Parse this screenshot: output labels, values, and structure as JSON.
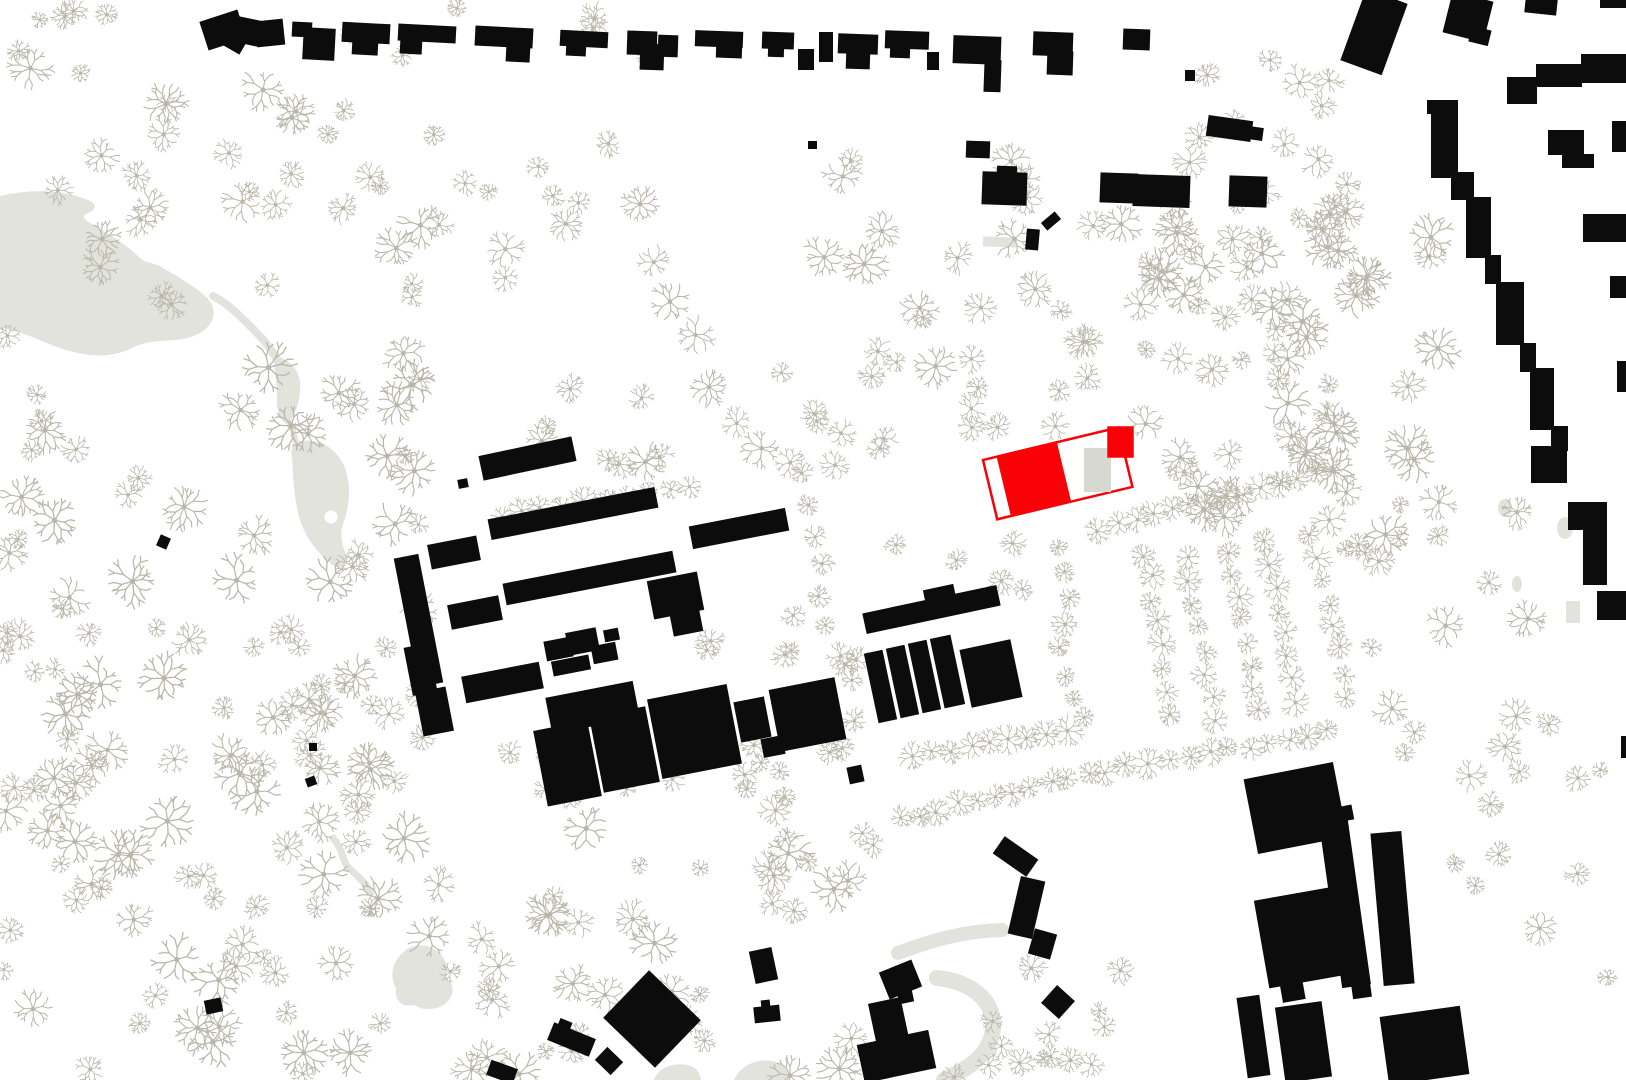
{
  "canvas": {
    "width": 1626,
    "height": 1080
  },
  "colors": {
    "background": "#ffffff",
    "building": "#0c0c0c",
    "tree": "#b7b7a9",
    "water": "#e3e3de",
    "path": "#e3e3de",
    "accent_red": "#f90207",
    "inner_gray": "#d8d8d3"
  },
  "water": {
    "lake": "M0,196 C30,189 62,189 88,200 C98,204 97,210 86,214 C82,216 84,220 92,224 C110,234 128,246 140,258 C146,264 154,262 163,268 C180,278 198,288 209,300 C218,311 214,326 198,334 C176,345 156,336 132,348 C104,362 72,354 42,341 C24,333 10,330 0,327 Z",
    "stream": "M213,296 C228,304 238,314 248,324 C260,336 270,346 277,360",
    "pond1": "M277,356 C294,362 302,374 300,392 C298,410 292,420 287,424 C278,420 276,406 277,392 C276,376 272,362 277,356 Z",
    "connector": "M288,420 C293,430 295,436 296,444",
    "pond2": "M296,442 C318,436 337,448 345,468 C352,488 349,508 343,524 C339,536 343,548 347,556 C350,566 340,572 330,563 C312,548 301,530 297,508 C293,488 293,470 292,458 C291,448 292,444 296,442 Z",
    "island": {
      "cx": 331,
      "cy": 517,
      "r": 6.5
    }
  },
  "paths": {
    "strokes": [
      {
        "d": "M898,953 C930,941 962,931 1002,930",
        "w": 14
      },
      {
        "d": "M937,978 C967,981 989,996 993,1019 C995,1041 984,1058 961,1071 C953,1076 948,1078 944,1080",
        "w": 16
      },
      {
        "d": "M333,838 C344,850 341,862 351,870 C360,878 367,885 371,893",
        "w": 7
      }
    ],
    "fills": [
      "M654,1080 C658,1068 672,1062 688,1065 C696,1067 700,1073 701,1080 Z",
      "M734,1080 C740,1066 756,1058 772,1061 C783,1063 789,1071 790,1080 Z",
      "M398,958 C406,946 420,942 432,948 C444,954 450,966 446,978 C453,982 455,992 449,1000 C441,1010 425,1012 414,1005 C402,1008 394,1000 396,988 C390,978 392,966 398,958 Z"
    ],
    "blobs": [
      {
        "cx": 1565,
        "cy": 528,
        "rx": 8,
        "ry": 11
      },
      {
        "cx": 1505,
        "cy": 508,
        "rx": 7,
        "ry": 9
      },
      {
        "cx": 1517,
        "cy": 584,
        "rx": 5,
        "ry": 8
      }
    ],
    "gray_rects": [
      [
        983,
        237,
        34,
        10,
        2
      ],
      [
        1566,
        601,
        14,
        22,
        0
      ]
    ]
  },
  "red_building": {
    "origin": [
      983,
      460
    ],
    "rot": -13.5,
    "w": 139,
    "h": 61,
    "red_fill_rect": [
      14,
      1,
      62,
      59
    ],
    "corner_square": [
      1108,
      427,
      25,
      30
    ],
    "gray_rect": [
      1084,
      448,
      27,
      44
    ],
    "stroke_w": 2.5
  },
  "buildings": [
    [
      203,
      15,
      40,
      30,
      -18
    ],
    [
      230,
      18,
      32,
      26,
      12
    ],
    [
      256,
      20,
      28,
      26,
      -6
    ],
    [
      222,
      30,
      24,
      20,
      30
    ],
    [
      292,
      22,
      20,
      15,
      3
    ],
    [
      303,
      28,
      32,
      32,
      3
    ],
    [
      342,
      23,
      48,
      20,
      3
    ],
    [
      352,
      40,
      26,
      15,
      3
    ],
    [
      398,
      25,
      58,
      17,
      3
    ],
    [
      400,
      40,
      22,
      14,
      3
    ],
    [
      475,
      27,
      58,
      20,
      3
    ],
    [
      506,
      45,
      24,
      17,
      3
    ],
    [
      560,
      31,
      48,
      16,
      3
    ],
    [
      566,
      44,
      20,
      12,
      3
    ],
    [
      627,
      31,
      30,
      24,
      2
    ],
    [
      640,
      44,
      24,
      26,
      2
    ],
    [
      658,
      35,
      20,
      22,
      2
    ],
    [
      695,
      31,
      48,
      16,
      2
    ],
    [
      716,
      44,
      26,
      14,
      2
    ],
    [
      762,
      32,
      32,
      17,
      2
    ],
    [
      768,
      45,
      16,
      12,
      2
    ],
    [
      798,
      49,
      16,
      21,
      0
    ],
    [
      819,
      32,
      14,
      30,
      0
    ],
    [
      838,
      34,
      40,
      20,
      2
    ],
    [
      846,
      51,
      24,
      18,
      2
    ],
    [
      885,
      31,
      44,
      18,
      2
    ],
    [
      890,
      46,
      20,
      12,
      2
    ],
    [
      927,
      52,
      12,
      18,
      0
    ],
    [
      953,
      36,
      48,
      28,
      2
    ],
    [
      984,
      60,
      17,
      32,
      2
    ],
    [
      1033,
      32,
      40,
      24,
      2
    ],
    [
      1047,
      51,
      26,
      24,
      2
    ],
    [
      1123,
      29,
      27,
      21,
      2
    ],
    [
      1207,
      118,
      45,
      21,
      8
    ],
    [
      1248,
      127,
      15,
      13,
      8
    ],
    [
      1185,
      70,
      10,
      11,
      0
    ],
    [
      1352,
      -6,
      44,
      76,
      20
    ],
    [
      1447,
      -4,
      42,
      42,
      14
    ],
    [
      1470,
      28,
      20,
      16,
      14
    ],
    [
      1525,
      -2,
      32,
      16,
      6
    ],
    [
      1600,
      -4,
      26,
      12,
      0
    ],
    [
      1507,
      77,
      30,
      27,
      0
    ],
    [
      1536,
      64,
      46,
      23,
      0
    ],
    [
      1581,
      54,
      45,
      29,
      0
    ],
    [
      1427,
      100,
      31,
      14,
      0
    ],
    [
      1431,
      112,
      27,
      66,
      0
    ],
    [
      1451,
      172,
      23,
      28,
      0
    ],
    [
      1466,
      197,
      25,
      61,
      0
    ],
    [
      1485,
      255,
      16,
      29,
      0
    ],
    [
      1496,
      282,
      28,
      63,
      0
    ],
    [
      1520,
      343,
      16,
      29,
      0
    ],
    [
      1530,
      368,
      24,
      62,
      0
    ],
    [
      1551,
      426,
      17,
      25,
      0
    ],
    [
      1531,
      446,
      36,
      37,
      0
    ],
    [
      1553,
      462,
      14,
      21,
      0
    ],
    [
      1548,
      130,
      36,
      25,
      0
    ],
    [
      1562,
      154,
      32,
      14,
      0
    ],
    [
      1612,
      121,
      14,
      31,
      0
    ],
    [
      1583,
      214,
      43,
      28,
      0
    ],
    [
      1610,
      276,
      16,
      22,
      0
    ],
    [
      1617,
      361,
      9,
      31,
      0
    ],
    [
      1568,
      502,
      39,
      28,
      0
    ],
    [
      1583,
      528,
      24,
      57,
      0
    ],
    [
      1597,
      591,
      29,
      29,
      0
    ],
    [
      1621,
      736,
      5,
      22,
      0
    ],
    [
      966,
      141,
      24,
      17,
      2
    ],
    [
      982,
      172,
      45,
      33,
      2
    ],
    [
      997,
      166,
      20,
      8,
      2
    ],
    [
      1100,
      173,
      38,
      30,
      2
    ],
    [
      1133,
      175,
      57,
      32,
      2
    ],
    [
      1229,
      176,
      38,
      31,
      2
    ],
    [
      1042,
      216,
      18,
      10,
      -40
    ],
    [
      1026,
      229,
      13,
      21,
      5
    ],
    [
      808,
      141,
      9,
      8,
      0
    ],
    [
      480,
      446,
      95,
      25,
      -12
    ],
    [
      429,
      540,
      50,
      25,
      -11
    ],
    [
      488,
      503,
      170,
      21,
      -11
    ],
    [
      449,
      600,
      52,
      25,
      -11
    ],
    [
      503,
      567,
      173,
      22,
      -11
    ],
    [
      690,
      517,
      98,
      23,
      -11
    ],
    [
      406,
      555,
      25,
      131,
      -11
    ],
    [
      408,
      645,
      25,
      49,
      -11
    ],
    [
      419,
      689,
      31,
      45,
      -11
    ],
    [
      463,
      669,
      79,
      27,
      -11
    ],
    [
      545,
      639,
      27,
      20,
      -11
    ],
    [
      567,
      630,
      31,
      23,
      -11
    ],
    [
      592,
      644,
      25,
      18,
      -11
    ],
    [
      604,
      629,
      15,
      12,
      -11
    ],
    [
      552,
      658,
      38,
      15,
      -11
    ],
    [
      650,
      576,
      51,
      39,
      -11
    ],
    [
      671,
      607,
      30,
      27,
      -11
    ],
    [
      548,
      689,
      89,
      37,
      -11
    ],
    [
      540,
      725,
      55,
      77,
      -11
    ],
    [
      596,
      711,
      57,
      77,
      -11
    ],
    [
      654,
      691,
      81,
      81,
      -11
    ],
    [
      737,
      699,
      31,
      41,
      -11
    ],
    [
      762,
      737,
      22,
      19,
      -11
    ],
    [
      774,
      683,
      67,
      63,
      -11
    ],
    [
      458,
      479,
      10,
      9,
      -11
    ],
    [
      863,
      599,
      137,
      21,
      -12
    ],
    [
      924,
      587,
      31,
      14,
      -12
    ],
    [
      871,
      651,
      19,
      71,
      -12
    ],
    [
      893,
      646,
      19,
      71,
      -12
    ],
    [
      915,
      641,
      19,
      71,
      -12
    ],
    [
      937,
      636,
      21,
      71,
      -12
    ],
    [
      965,
      644,
      52,
      59,
      -12
    ],
    [
      848,
      766,
      15,
      17,
      -12
    ],
    [
      752,
      949,
      23,
      33,
      -12
    ],
    [
      754,
      1006,
      26,
      16,
      -6
    ],
    [
      761,
      1000,
      9,
      7,
      -6
    ],
    [
      883,
      965,
      35,
      29,
      -22
    ],
    [
      872,
      1000,
      33,
      42,
      -12
    ],
    [
      860,
      1037,
      73,
      39,
      -12
    ],
    [
      898,
      990,
      15,
      13,
      -12
    ],
    [
      995,
      846,
      41,
      21,
      35
    ],
    [
      1014,
      878,
      25,
      59,
      13
    ],
    [
      1031,
      931,
      23,
      26,
      16
    ],
    [
      1046,
      990,
      24,
      24,
      42
    ],
    [
      549,
      1030,
      45,
      19,
      22
    ],
    [
      558,
      1020,
      13,
      11,
      22
    ],
    [
      616,
      986,
      72,
      66,
      44
    ],
    [
      598,
      1052,
      22,
      18,
      44
    ],
    [
      488,
      1064,
      28,
      16,
      20
    ],
    [
      205,
      999,
      17,
      14,
      -12
    ],
    [
      158,
      536,
      11,
      12,
      24
    ],
    [
      309,
      743,
      8,
      8,
      0
    ],
    [
      306,
      777,
      10,
      9,
      -20
    ],
    [
      1250,
      770,
      91,
      76,
      -11
    ],
    [
      1336,
      806,
      17,
      15,
      -11
    ],
    [
      1330,
      814,
      29,
      173,
      -8
    ],
    [
      1377,
      832,
      31,
      153,
      -5
    ],
    [
      1261,
      893,
      81,
      89,
      -10
    ],
    [
      1281,
      980,
      23,
      21,
      -10
    ],
    [
      1242,
      996,
      23,
      81,
      -8
    ],
    [
      1280,
      1004,
      47,
      76,
      -8
    ],
    [
      1384,
      1011,
      81,
      69,
      -8
    ],
    [
      1352,
      983,
      19,
      15,
      -8
    ]
  ],
  "trees": {
    "rows": [
      {
        "pts": [
          [
            640,
            205
          ],
          [
            655,
            262
          ],
          [
            670,
            302
          ],
          [
            697,
            335
          ],
          [
            710,
            388
          ],
          [
            736,
            424
          ],
          [
            762,
            448
          ],
          [
            792,
            463
          ]
        ],
        "r": 15,
        "seed": 301
      },
      {
        "from": [
          500,
          514
        ],
        "to": [
          690,
          486
        ],
        "n": 10,
        "r": 11,
        "seed": 302
      },
      {
        "pts": [
          [
            800,
            472
          ],
          [
            808,
            505
          ],
          [
            816,
            535
          ],
          [
            822,
            565
          ],
          [
            820,
            595
          ],
          [
            826,
            625
          ],
          [
            840,
            655
          ],
          [
            852,
            680
          ]
        ],
        "r": 11,
        "seed": 303
      },
      {
        "from": [
          913,
          757
        ],
        "to": [
          1067,
          729
        ],
        "n": 9,
        "r": 11,
        "seed": 304
      },
      {
        "from": [
          900,
          818
        ],
        "to": [
          1145,
          762
        ],
        "n": 14,
        "r": 11,
        "seed": 305
      },
      {
        "from": [
          1170,
          762
        ],
        "to": [
          1327,
          731
        ],
        "n": 9,
        "r": 11,
        "seed": 306
      },
      {
        "from": [
          1100,
          529
        ],
        "to": [
          1332,
          470
        ],
        "n": 14,
        "r": 11,
        "seed": 307
      },
      {
        "pts": [
          [
            1056,
            546
          ],
          [
            1065,
            572
          ],
          [
            1071,
            597
          ],
          [
            1066,
            623
          ],
          [
            1060,
            649
          ],
          [
            1066,
            675
          ],
          [
            1075,
            699
          ],
          [
            1083,
            717
          ]
        ],
        "r": 10,
        "seed": 308
      },
      {
        "from": [
          1146,
          554
        ],
        "to": [
          1172,
          715
        ],
        "n": 8,
        "r": 11,
        "seed": 309
      },
      {
        "from": [
          1186,
          560
        ],
        "to": [
          1215,
          718
        ],
        "n": 8,
        "r": 11,
        "seed": 310
      },
      {
        "from": [
          1228,
          552
        ],
        "to": [
          1258,
          709
        ],
        "n": 8,
        "r": 11,
        "seed": 311
      },
      {
        "from": [
          1266,
          543
        ],
        "to": [
          1297,
          700
        ],
        "n": 8,
        "r": 11,
        "seed": 312
      },
      {
        "from": [
          1312,
          532
        ],
        "to": [
          1348,
          696
        ],
        "n": 8,
        "r": 11,
        "seed": 313
      }
    ],
    "clusters": [
      {
        "x": 0,
        "y": 55,
        "w": 320,
        "h": 150,
        "count": 16,
        "rmin": 9,
        "rmax": 20,
        "seed": 11
      },
      {
        "x": 0,
        "y": 200,
        "w": 430,
        "h": 360,
        "count": 42,
        "rmin": 9,
        "rmax": 24,
        "seed": 22
      },
      {
        "x": 0,
        "y": 560,
        "w": 440,
        "h": 520,
        "count": 105,
        "rmin": 9,
        "rmax": 23,
        "seed": 33
      },
      {
        "x": 440,
        "y": 820,
        "w": 440,
        "h": 260,
        "count": 42,
        "rmin": 8,
        "rmax": 22,
        "seed": 44
      },
      {
        "x": 430,
        "y": 240,
        "w": 250,
        "h": 230,
        "count": 11,
        "rmin": 9,
        "rmax": 20,
        "seed": 55
      },
      {
        "x": 290,
        "y": 110,
        "w": 370,
        "h": 120,
        "count": 13,
        "rmin": 8,
        "rmax": 18,
        "seed": 66
      },
      {
        "x": 760,
        "y": 155,
        "w": 590,
        "h": 145,
        "count": 26,
        "rmin": 9,
        "rmax": 21,
        "seed": 77
      },
      {
        "x": 760,
        "y": 300,
        "w": 220,
        "h": 170,
        "count": 15,
        "rmin": 9,
        "rmax": 20,
        "seed": 78
      },
      {
        "x": 900,
        "y": 305,
        "w": 190,
        "h": 125,
        "count": 8,
        "rmin": 8,
        "rmax": 16,
        "seed": 88
      },
      {
        "x": 1150,
        "y": 230,
        "w": 290,
        "h": 330,
        "count": 48,
        "rmin": 9,
        "rmax": 23,
        "seed": 99
      },
      {
        "x": 1190,
        "y": 60,
        "w": 160,
        "h": 170,
        "count": 12,
        "rmin": 8,
        "rmax": 18,
        "seed": 98
      },
      {
        "x": 1340,
        "y": 470,
        "w": 190,
        "h": 290,
        "count": 16,
        "rmin": 8,
        "rmax": 19,
        "seed": 100
      },
      {
        "x": 1430,
        "y": 720,
        "w": 180,
        "h": 320,
        "count": 13,
        "rmin": 8,
        "rmax": 18,
        "seed": 111
      },
      {
        "x": 880,
        "y": 1040,
        "w": 240,
        "h": 40,
        "count": 6,
        "rmin": 7,
        "rmax": 13,
        "seed": 122
      },
      {
        "x": 990,
        "y": 950,
        "w": 140,
        "h": 120,
        "count": 9,
        "rmin": 7,
        "rmax": 14,
        "seed": 133
      },
      {
        "x": 330,
        "y": 0,
        "w": 330,
        "h": 60,
        "count": 7,
        "rmin": 7,
        "rmax": 15,
        "seed": 144
      },
      {
        "x": 0,
        "y": 0,
        "w": 200,
        "h": 55,
        "count": 5,
        "rmin": 7,
        "rmax": 14,
        "seed": 155
      },
      {
        "x": 690,
        "y": 610,
        "w": 140,
        "h": 120,
        "count": 5,
        "rmin": 8,
        "rmax": 14,
        "seed": 166
      },
      {
        "x": 1050,
        "y": 290,
        "w": 290,
        "h": 170,
        "count": 12,
        "rmin": 8,
        "rmax": 18,
        "seed": 177
      },
      {
        "x": 820,
        "y": 600,
        "w": 60,
        "h": 150,
        "count": 5,
        "rmin": 8,
        "rmax": 14,
        "seed": 188
      },
      {
        "x": 450,
        "y": 700,
        "w": 120,
        "h": 90,
        "count": 4,
        "rmin": 8,
        "rmax": 14,
        "seed": 190
      },
      {
        "x": 560,
        "y": 735,
        "w": 300,
        "h": 85,
        "count": 12,
        "rmin": 8,
        "rmax": 15,
        "seed": 191
      },
      {
        "x": 895,
        "y": 530,
        "w": 140,
        "h": 70,
        "count": 5,
        "rmin": 8,
        "rmax": 14,
        "seed": 201
      }
    ]
  }
}
